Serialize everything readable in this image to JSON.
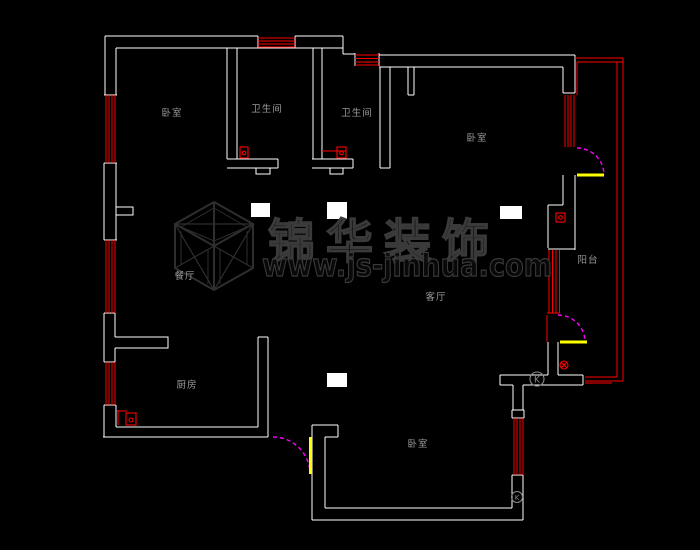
{
  "drawing_type": "apartment-floor-plan-cad",
  "colors": {
    "background": "#000000",
    "wall": "#ffffff",
    "window": "#ff0000",
    "balcony_outline": "#ff0000",
    "door_swing": "#ff00ff",
    "door_leaf": "#ffff00",
    "room_label": "#9a9a9a",
    "watermark": "#3a3a3a"
  },
  "rooms": [
    {
      "id": "bedroom-top-left",
      "label": "卧室"
    },
    {
      "id": "bathroom-1",
      "label": "卫生间"
    },
    {
      "id": "bathroom-2",
      "label": "卫生间"
    },
    {
      "id": "bedroom-top-right",
      "label": "卧室"
    },
    {
      "id": "dining",
      "label": "餐厅"
    },
    {
      "id": "balcony",
      "label": "阳台"
    },
    {
      "id": "living",
      "label": "客厅"
    },
    {
      "id": "kitchen",
      "label": "厨房"
    },
    {
      "id": "bedroom-bottom",
      "label": "卧室"
    }
  ],
  "watermark": {
    "logo": "isometric-cube-logo",
    "brand_text": "锦华装饰",
    "website_text": "www.js-jinhua.com"
  },
  "symbols": {
    "appliance_circle_1": "K",
    "appliance_circle_2": "K"
  }
}
